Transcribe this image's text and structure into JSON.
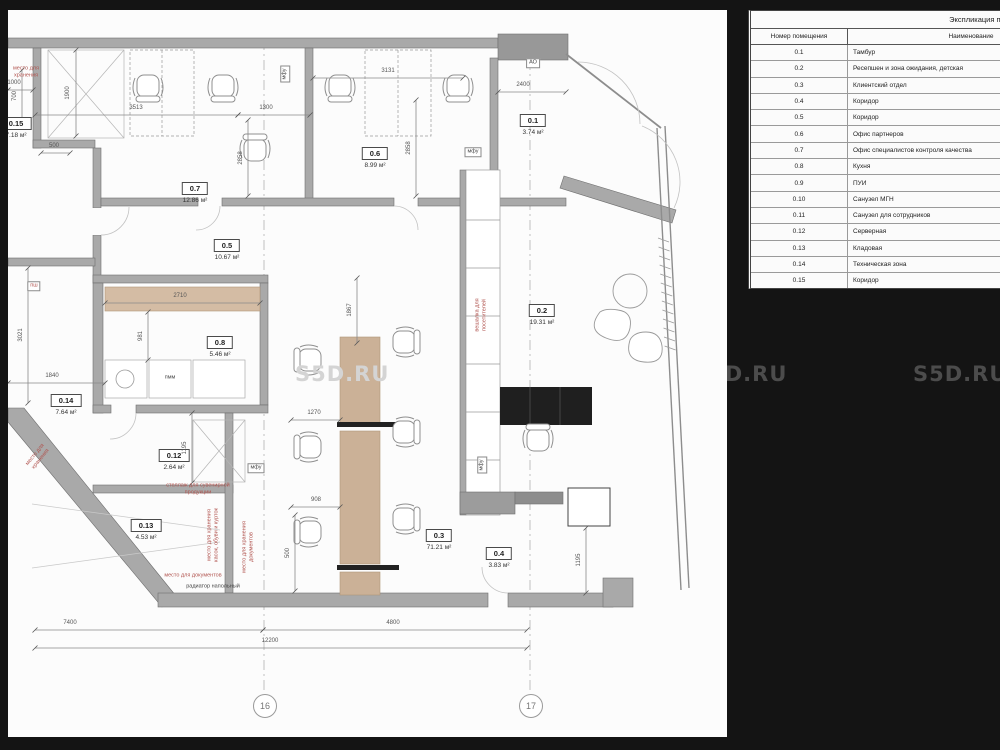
{
  "watermark": {
    "text": "S5D.RU",
    "positions": [
      {
        "x": 287,
        "y": 352,
        "light": true,
        "in_plan": true
      },
      {
        "x": 693,
        "y": 362,
        "light": false,
        "in_plan": false
      },
      {
        "x": 913,
        "y": 362,
        "light": false,
        "in_plan": false
      }
    ]
  },
  "explication_table": {
    "title": "Экспликация помещений",
    "columns": [
      "Номер помещения",
      "Наименование"
    ],
    "rows": [
      {
        "num": "0.1",
        "name": "Тамбур"
      },
      {
        "num": "0.2",
        "name": "Ресепшен и зона ожидания, детская"
      },
      {
        "num": "0.3",
        "name": "Клиентский отдел"
      },
      {
        "num": "0.4",
        "name": "Коридор"
      },
      {
        "num": "0.5",
        "name": "Коридор"
      },
      {
        "num": "0.6",
        "name": "Офис партнеров"
      },
      {
        "num": "0.7",
        "name": "Офис специалистов контроля качества"
      },
      {
        "num": "0.8",
        "name": "Кухня"
      },
      {
        "num": "0.9",
        "name": "ПУИ"
      },
      {
        "num": "0.10",
        "name": "Санузел МГН"
      },
      {
        "num": "0.11",
        "name": "Санузел для сотрудников"
      },
      {
        "num": "0.12",
        "name": "Серверная"
      },
      {
        "num": "0.13",
        "name": "Кладовая"
      },
      {
        "num": "0.14",
        "name": "Техническая зона"
      },
      {
        "num": "0.15",
        "name": "Коридор"
      }
    ]
  },
  "plan": {
    "rooms": [
      {
        "num": "0.15",
        "area": "7.18 м²",
        "x": 8,
        "y": 103
      },
      {
        "num": "0.7",
        "area": "12.86 м²",
        "x": 187,
        "y": 168
      },
      {
        "num": "0.5",
        "area": "10.67 м²",
        "x": 219,
        "y": 225
      },
      {
        "num": "0.6",
        "area": "8.99 м²",
        "x": 367,
        "y": 133
      },
      {
        "num": "0.1",
        "area": "3.74 м²",
        "x": 525,
        "y": 100
      },
      {
        "num": "0.8",
        "area": "5.46 м²",
        "x": 212,
        "y": 322
      },
      {
        "num": "0.14",
        "area": "7.64 м²",
        "x": 58,
        "y": 380
      },
      {
        "num": "0.12",
        "area": "2.64 м²",
        "x": 166,
        "y": 435
      },
      {
        "num": "0.13",
        "area": "4.53 м²",
        "x": 138,
        "y": 505
      },
      {
        "num": "0.2",
        "area": "19.31 м²",
        "x": 534,
        "y": 290
      },
      {
        "num": "0.3",
        "area": "71.21 м²",
        "x": 431,
        "y": 515
      },
      {
        "num": "0.4",
        "area": "3.83 м²",
        "x": 491,
        "y": 533
      }
    ],
    "dimensions": [
      {
        "t": "3513",
        "line": [
          27,
          105,
          230,
          105
        ],
        "lx": 128,
        "ly": 98
      },
      {
        "t": "1300",
        "line": [
          230,
          105,
          302,
          105
        ],
        "lx": 258,
        "ly": 98
      },
      {
        "t": "3131",
        "line": [
          305,
          68,
          455,
          68
        ],
        "lx": 380,
        "ly": 61
      },
      {
        "t": "2400",
        "line": [
          490,
          82,
          558,
          82
        ],
        "lx": 515,
        "ly": 75
      },
      {
        "t": "1900",
        "line": [
          68,
          40,
          68,
          126
        ],
        "lx": 60,
        "ly": 83,
        "v": true
      },
      {
        "t": "2858",
        "line": [
          240,
          110,
          240,
          186
        ],
        "lx": 233,
        "ly": 148,
        "v": true
      },
      {
        "t": "2858",
        "line": [
          408,
          90,
          408,
          186
        ],
        "lx": 401,
        "ly": 138,
        "v": true
      },
      {
        "t": "500",
        "line": [
          33,
          143,
          62,
          143
        ],
        "lx": 46,
        "ly": 136
      },
      {
        "t": "1000",
        "line": [
          0,
          80,
          25,
          80
        ],
        "lx": 6,
        "ly": 73
      },
      {
        "t": "700",
        "line": [
          14,
          60,
          14,
          112
        ],
        "lx": 7,
        "ly": 86,
        "v": true
      },
      {
        "t": "2710",
        "line": [
          97,
          293,
          252,
          293
        ],
        "lx": 172,
        "ly": 286
      },
      {
        "t": "981",
        "line": [
          140,
          302,
          140,
          350
        ],
        "lx": 133,
        "ly": 326,
        "v": true
      },
      {
        "t": "1867",
        "line": [
          349,
          268,
          349,
          333
        ],
        "lx": 342,
        "ly": 300,
        "v": true
      },
      {
        "t": "3021",
        "line": [
          20,
          258,
          20,
          393
        ],
        "lx": 13,
        "ly": 325,
        "v": true
      },
      {
        "t": "1840",
        "line": [
          0,
          373,
          97,
          373
        ],
        "lx": 44,
        "ly": 366
      },
      {
        "t": "1270",
        "line": [
          283,
          410,
          332,
          410
        ],
        "lx": 306,
        "ly": 403
      },
      {
        "t": "908",
        "line": [
          283,
          497,
          332,
          497
        ],
        "lx": 308,
        "ly": 490
      },
      {
        "t": "500",
        "line": [
          287,
          505,
          287,
          581
        ],
        "lx": 280,
        "ly": 543,
        "v": true
      },
      {
        "t": "1195",
        "line": [
          184,
          403,
          184,
          473
        ],
        "lx": 177,
        "ly": 438,
        "v": true
      },
      {
        "t": "1195",
        "line": [
          578,
          518,
          578,
          583
        ],
        "lx": 571,
        "ly": 550,
        "v": true
      },
      {
        "t": "7400",
        "line": [
          27,
          620,
          255,
          620
        ],
        "lx": 62,
        "ly": 613
      },
      {
        "t": "4800",
        "line": [
          255,
          620,
          519,
          620
        ],
        "lx": 385,
        "ly": 613
      },
      {
        "t": "12200",
        "line": [
          27,
          638,
          519,
          638
        ],
        "lx": 262,
        "ly": 631
      }
    ],
    "equipment": [
      {
        "t": "АО",
        "x": 525,
        "y": 53,
        "box": true
      },
      {
        "t": "мфу",
        "x": 277,
        "y": 64,
        "box": true,
        "rot": -90
      },
      {
        "t": "мфу",
        "x": 465,
        "y": 142,
        "box": true
      },
      {
        "t": "мфу",
        "x": 248,
        "y": 458,
        "box": true
      },
      {
        "t": "мфу",
        "x": 474,
        "y": 455,
        "box": true,
        "rot": -90
      },
      {
        "t": "пш",
        "x": 26,
        "y": 276,
        "box": true,
        "red": true
      },
      {
        "t": "пмм",
        "x": 162,
        "y": 368
      },
      {
        "t": "радиатор напольный",
        "x": 205,
        "y": 577
      }
    ],
    "red_notes": [
      {
        "t": "место для\nхранения",
        "x": 18,
        "y": 62
      },
      {
        "t": "стеллаж для сувенирной\nпродукции",
        "x": 190,
        "y": 479
      },
      {
        "t": "место для хранения\nкасок, обуви и курток",
        "x": 205,
        "y": 525,
        "rot": -90
      },
      {
        "t": "место для хранения\nдокументов",
        "x": 240,
        "y": 537,
        "rot": -90
      },
      {
        "t": "вешалка для\nпосетителей",
        "x": 473,
        "y": 305,
        "rot": -90
      },
      {
        "t": "место для\nхранения",
        "x": 30,
        "y": 447,
        "rot": -51
      },
      {
        "t": "место для документов",
        "x": 185,
        "y": 566
      }
    ],
    "grid_axes": [
      {
        "label": "16",
        "x": 256
      },
      {
        "label": "17",
        "x": 522
      }
    ]
  }
}
